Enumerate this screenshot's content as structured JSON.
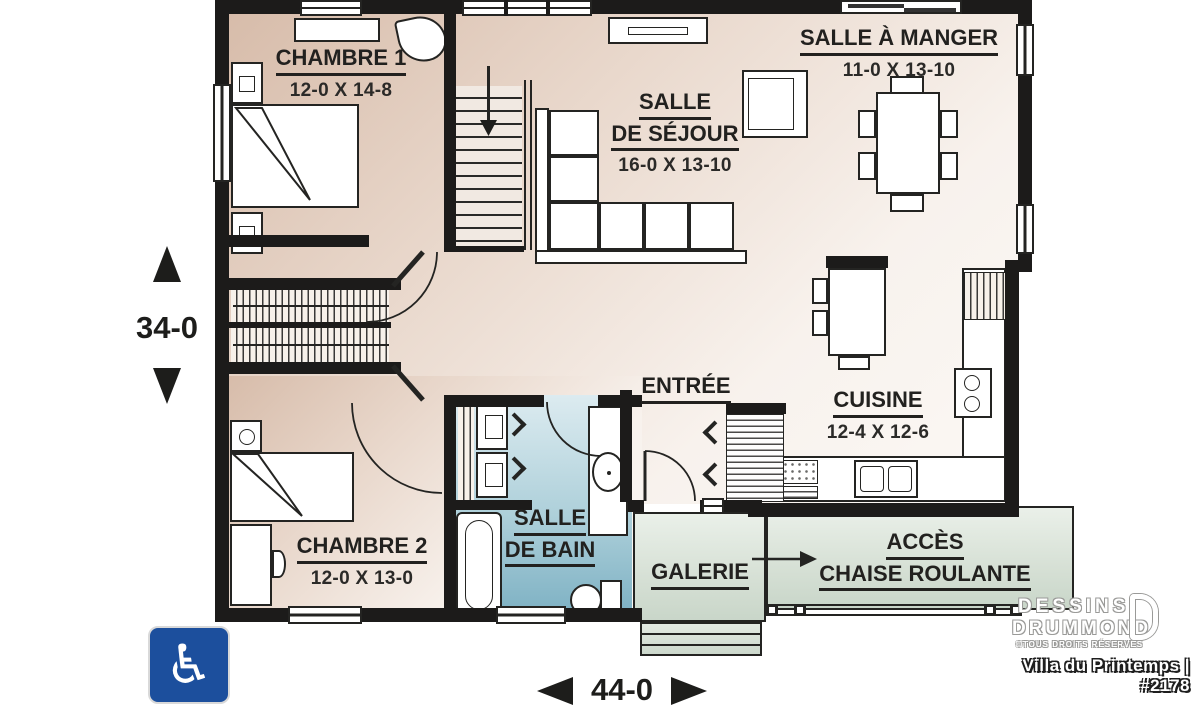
{
  "title_block": {
    "plan_title": "Villa du Printemps | #2178",
    "brand_line1": "DESSINS",
    "brand_line2": "DRUMMOND",
    "copyright": "©TOUS DROITS RÉSERVÉS"
  },
  "dimensions": {
    "overall_depth": "34-0",
    "overall_width": "44-0"
  },
  "rooms": {
    "chambre1": {
      "name": "CHAMBRE 1",
      "size": "12-0 X 14-8"
    },
    "salle_a_manger": {
      "name": "SALLE À MANGER",
      "size": "11-0 X 13-10"
    },
    "salle_de_sejour": {
      "name_line1": "SALLE",
      "name_line2": "DE SÉJOUR",
      "size": "16-0 X 13-10"
    },
    "entree": {
      "name": "ENTRÉE"
    },
    "cuisine": {
      "name": "CUISINE",
      "size": "12-4 X 12-6"
    },
    "chambre2": {
      "name": "CHAMBRE 2",
      "size": "12-0 X 13-0"
    },
    "salle_de_bain": {
      "name_line1": "SALLE",
      "name_line2": "DE BAIN"
    },
    "galerie": {
      "name": "GALERIE"
    },
    "acces": {
      "name_line1": "ACCÈS",
      "name_line2": "CHAISE ROULANTE"
    }
  },
  "icons": {
    "accessibility_symbol": "♿"
  },
  "colors": {
    "wall": "#1c1b1a",
    "floor_warm_dark": "#d7bcaa",
    "floor_warm_light": "#fbf8f5",
    "bath_top": "#dcebf0",
    "bath_bottom": "#7fb2c4",
    "porch_top": "#eaf0e9",
    "porch_bottom": "#c9d6c9",
    "accessibility_blue": "#1c4f9d"
  }
}
